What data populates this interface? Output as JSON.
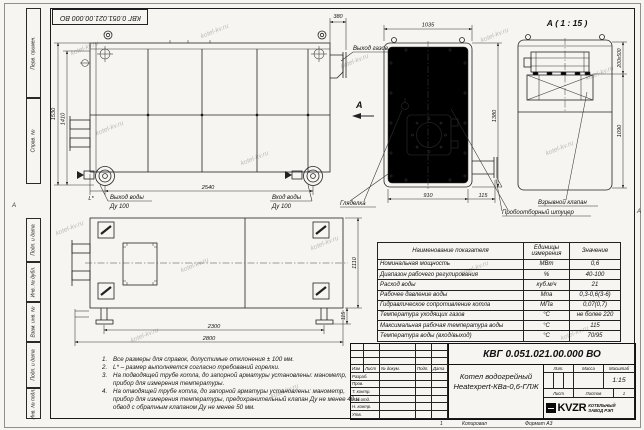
{
  "watermark_text": "kotel-kv.ru",
  "sheet": {
    "stamp_rotated": "КВГ 0.051.021.00.000 ВО",
    "zone_left": "А",
    "zone_right": "А",
    "side_strip": [
      "Перв. примен.",
      "Справ. №",
      "Подп. и дата",
      "Инв. № дубл.",
      "Взам. инв. №",
      "Подп. и дата",
      "Инв. № подл."
    ],
    "footer": {
      "zone": "1",
      "copied_label": "Копировал",
      "format_label": "Формат А3"
    }
  },
  "views": {
    "side": {
      "dim_height_outer": "1530",
      "dim_height_inner": "1410",
      "dim_length": "2540",
      "dim_l": "L*",
      "dim_top": "380",
      "label_gas_out": "Выход газов",
      "label_water_out": "Выход воды",
      "label_water_out_dn": "Ду 100",
      "label_water_in": "Вход воды",
      "label_water_in_dn": "Ду 100"
    },
    "front": {
      "dim_width_top": "1035",
      "dim_width_bottom": "910",
      "dim_offset": "115",
      "dim_height": "1380",
      "section_letter": "A",
      "label_sight": "Гляделка",
      "label_sampling": "Пробоотборный штуцер"
    },
    "detail": {
      "title": "А ( 1 : 15 )",
      "dim_valve": "200х500",
      "dim_height": "1090",
      "label_valve": "Взрывной клапан"
    },
    "plan": {
      "dim_length_inner": "2300",
      "dim_length_outer": "2800",
      "dim_width": "1110",
      "dim_foot": "115"
    }
  },
  "notes": [
    {
      "num": "1.",
      "text": "Все размеры для справок, допустимые отклонения ± 100 мм."
    },
    {
      "num": "2.",
      "text": "L* – размер выполняется согласно требований горелки."
    },
    {
      "num": "3.",
      "text": "На подводящей трубе котла, до запорной арматуры установлены: манометр, прибор для измерения температуры."
    },
    {
      "num": "4.",
      "text": "На отводящей трубе котла, до запорной арматуры установлены: манометр, прибор для измерения температуры, предохранительный клапан Ду не менее 40 и обвод с обратным клапаном Ду не менее 50 мм."
    }
  ],
  "spec_table": {
    "headers": [
      "Наименование показателя",
      "Единицы измерения",
      "Значение"
    ],
    "rows": [
      [
        "Номинальная мощность",
        "МВт",
        "0,6"
      ],
      [
        "Диапазон рабочего регулирования",
        "%",
        "40-100"
      ],
      [
        "Расход воды",
        "куб.м/ч",
        "21"
      ],
      [
        "Рабочее давление воды",
        "Мпа",
        "0,3-0,6(3-6)"
      ],
      [
        "Гидравлическое сопротивление котла",
        "МПа",
        "0,07(0,7)"
      ],
      [
        "Температура уходящих газов",
        "°С",
        "не более 220"
      ],
      [
        "Максимальная рабочая температура воды",
        "°С",
        "115"
      ],
      [
        "Температура воды (вход/выход)",
        "°С",
        "70/95"
      ]
    ]
  },
  "title_block": {
    "doc_number": "КВГ 0.051.021.00.000 ВО",
    "product_line1": "Котел водогрейный",
    "product_line2": "Heatexpert-КВа-0,6-ГЛЖ",
    "col_izm": "Изм",
    "col_list": "Лист",
    "col_doc": "№ докум.",
    "col_sign": "Подп.",
    "col_date": "Дата",
    "rows": [
      "Разраб.",
      "Пров.",
      "Т. контр.",
      "Нач.отд.",
      "Н. контр.",
      "Утв."
    ],
    "lit_label": "Лит.",
    "mass_label": "Масса",
    "scale_label": "Масштаб",
    "scale_value": "1:15",
    "sheet_label": "Лист",
    "sheets_label": "Листов",
    "sheets_value": "1",
    "logo_text": "KVZR",
    "company_line1": "КОТЕЛЬНЫЙ",
    "company_line2": "ЗАВОД РЭП"
  }
}
